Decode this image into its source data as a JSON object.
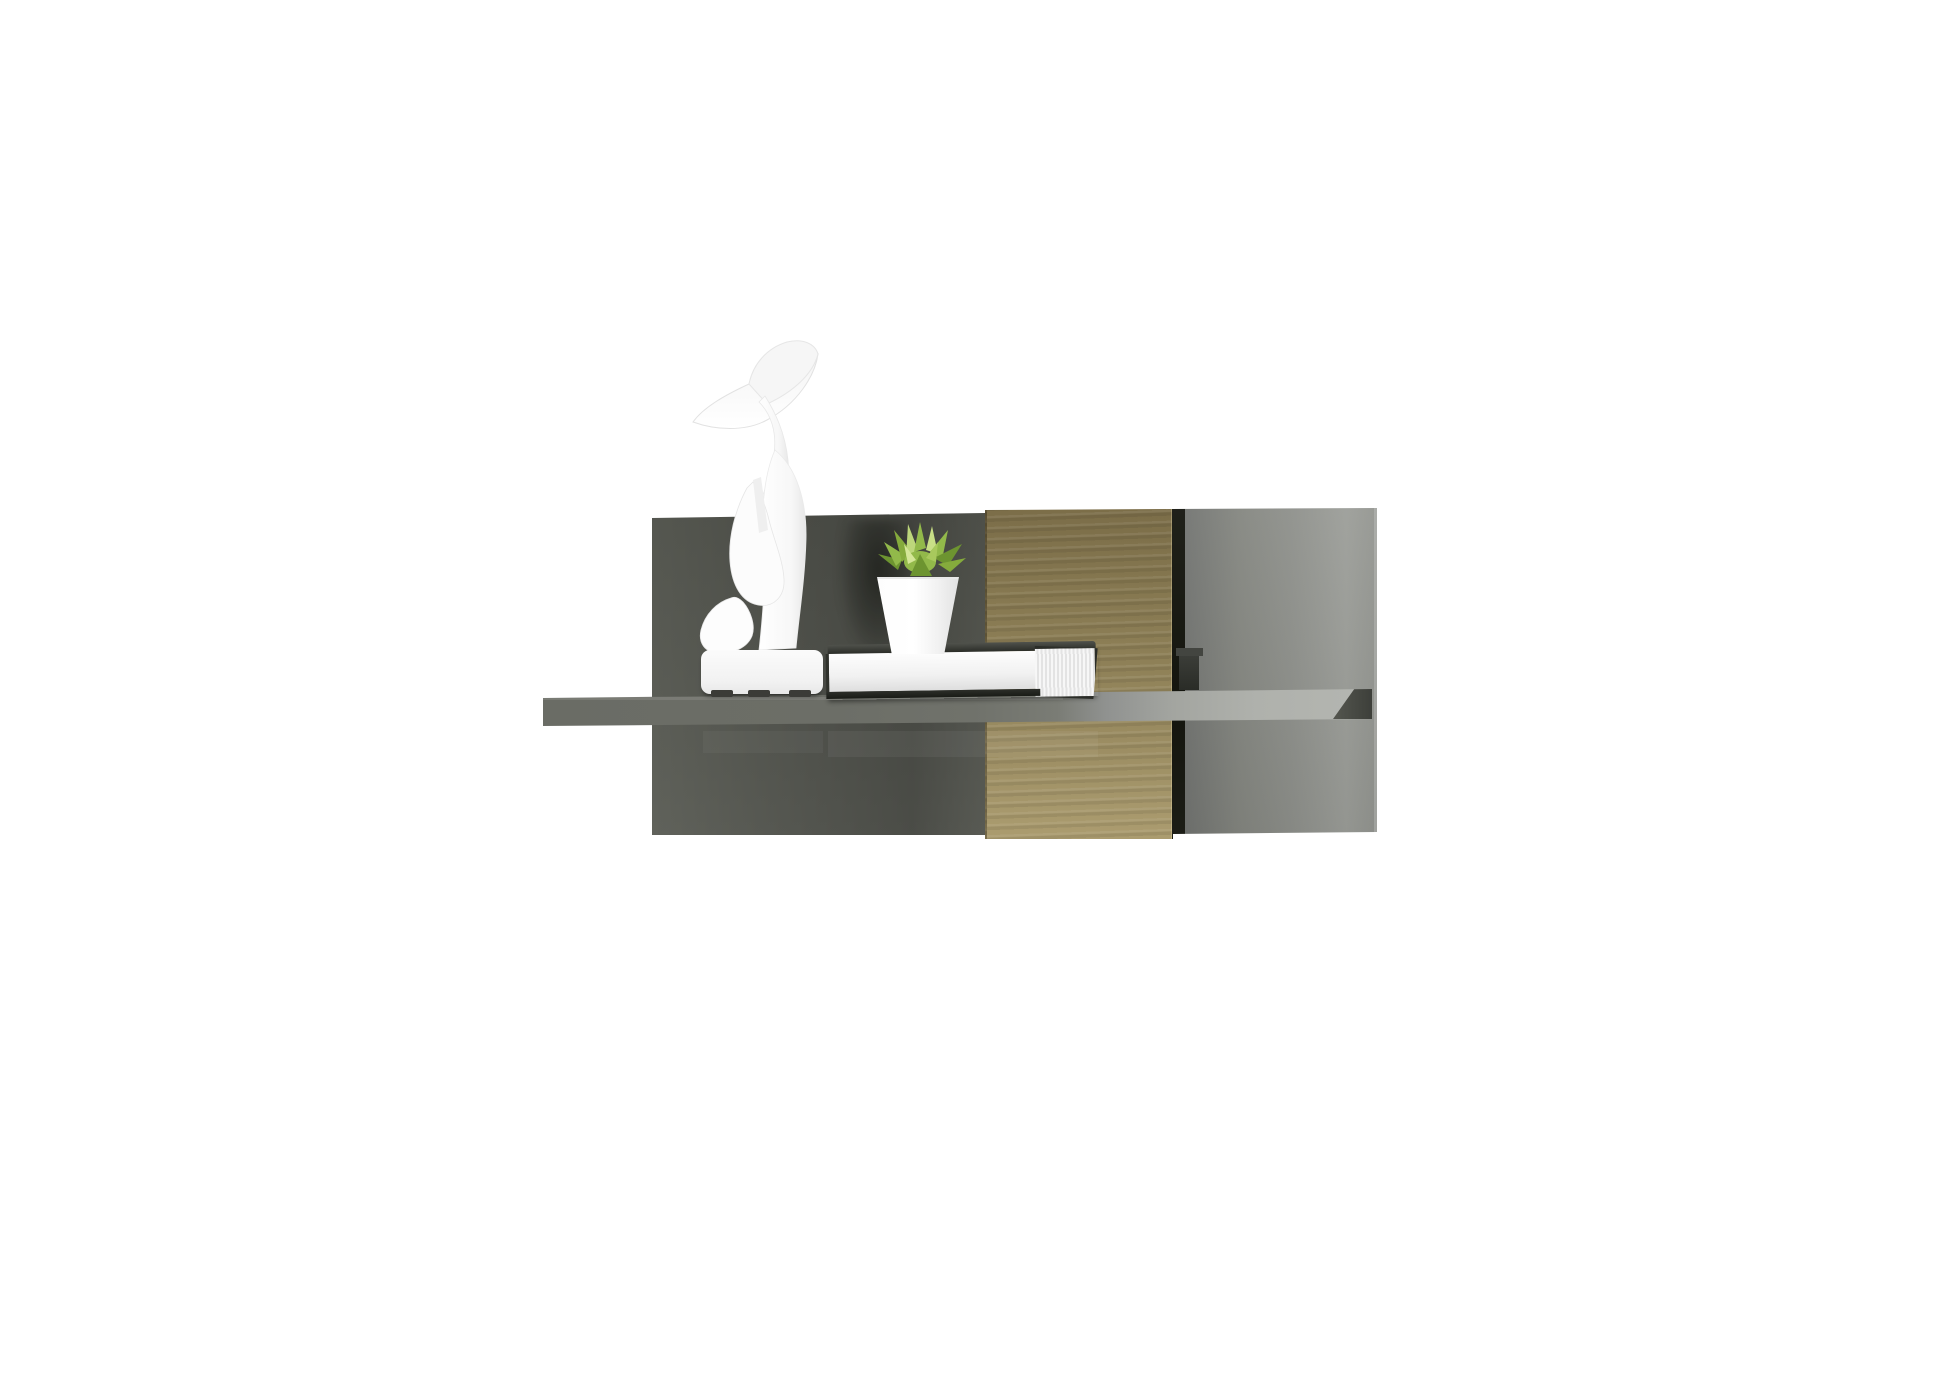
{
  "scene": {
    "type": "product-photo",
    "label": "Wall-mounted floating shelf with grey gloss back panel, oak stripe and decor items on white background",
    "background": "#ffffff"
  },
  "furniture": {
    "back_panel_label": "glossy grey back panel",
    "wood_stripe_label": "oak wood stripe panel",
    "gap_label": "dark vertical groove",
    "bracket_label": "metal connector in groove",
    "shelf_label": "grey floating shelf board",
    "shelf_end_label": "shadowed right end of shelf"
  },
  "decor": {
    "statue_label": "white abstract silence figurine with swoosh hat",
    "statue_base_label": "white figurine base with dark feet pads",
    "plant_label": "green succulent plant",
    "pot_label": "small white tapered pot",
    "book_label": "white book with dark cover edges"
  },
  "colors": {
    "bg": "#ffffff",
    "panel-left": "#54564f",
    "panel-left-2": "#60625b",
    "panel-right": "#83857f",
    "panel-right-2": "#9b9d98",
    "wood-1": "#7b6d48",
    "wood-2": "#8d7f56",
    "wood-3": "#a6976b",
    "gap": "#14150e",
    "shelf-1": "#6a6c65",
    "shelf-3": "#afb1ac",
    "shelf-end": "#3d3f3a",
    "statue": "#fbfbfb",
    "statue-shade": "#e7e7e7",
    "pot": "#ffffff",
    "pot-shade": "#e2e2e2",
    "leaf-dark": "#6d9430",
    "leaf-mid": "#92b94a",
    "leaf-light": "#bdd77b",
    "book-cover": "#2b2d28",
    "book-pages": "#f1f1f1",
    "feet": "#3b3b37"
  }
}
